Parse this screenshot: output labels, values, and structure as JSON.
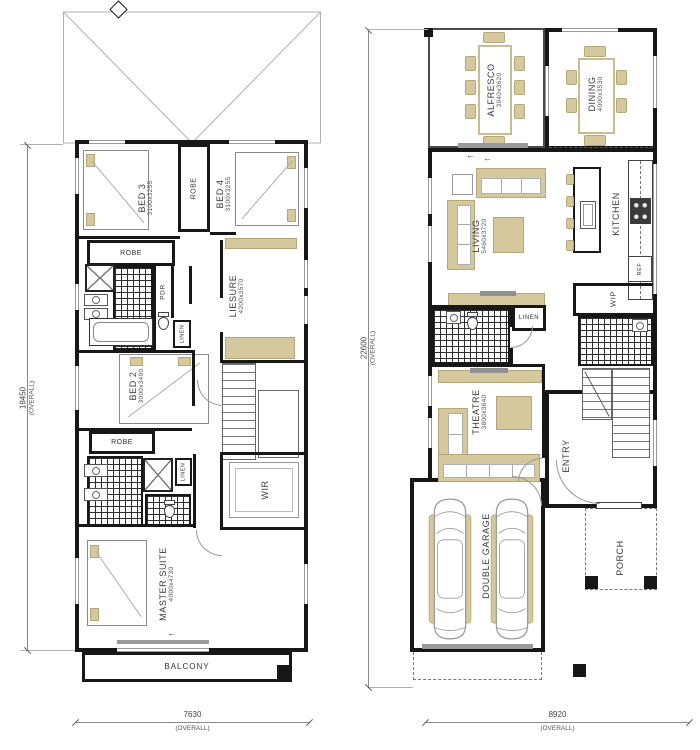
{
  "plan": {
    "upper": {
      "bed3": {
        "name": "BED 3",
        "dims": "3100x3255"
      },
      "bed4": {
        "name": "BED 4",
        "dims": "3100x3255"
      },
      "bed2": {
        "name": "BED 2",
        "dims": "3000x3490"
      },
      "liesure": {
        "name": "LIESURE",
        "dims": "4200x3570"
      },
      "master": {
        "name": "MASTER SUITE",
        "dims": "4000x4730"
      },
      "wir": {
        "name": "WIR"
      },
      "balcony": {
        "name": "BALCONY"
      },
      "robe_beds": "ROBE",
      "robe_bed3": "ROBE",
      "robe_bed2": "ROBE",
      "pdr": "PDR",
      "linen_hall": "LINEN",
      "linen_ens": "LINEN",
      "dim_vertical": {
        "value": "18450",
        "qualifier": "(OVERALL)"
      },
      "dim_horizontal": {
        "value": "7630",
        "qualifier": "(OVERALL)"
      }
    },
    "ground": {
      "alfresco": {
        "name": "ALFRESCO",
        "dims": "3940x3620"
      },
      "dining": {
        "name": "DINING",
        "dims": "4000x3530"
      },
      "living": {
        "name": "LIVING",
        "dims": "5460x3720"
      },
      "kitchen": {
        "name": "KITCHEN"
      },
      "theatre": {
        "name": "THEATRE",
        "dims": "3800x3640"
      },
      "garage": {
        "name": "DOUBLE GARAGE",
        "dims": "6000x5900"
      },
      "entry": {
        "name": "ENTRY"
      },
      "porch": {
        "name": "PORCH"
      },
      "wip": "WIP",
      "ref": "REF",
      "linen": "LINEN",
      "dim_vertical": {
        "value": "22600",
        "qualifier": "(OVERALL)"
      },
      "dim_horizontal": {
        "value": "8920",
        "qualifier": "(OVERALL)"
      }
    },
    "misc": {
      "slide_arrow": "←"
    },
    "colors": {
      "wall": "#171717",
      "furniture_accent": "#d5c89c",
      "drawing_line": "#9a9a9a"
    }
  }
}
